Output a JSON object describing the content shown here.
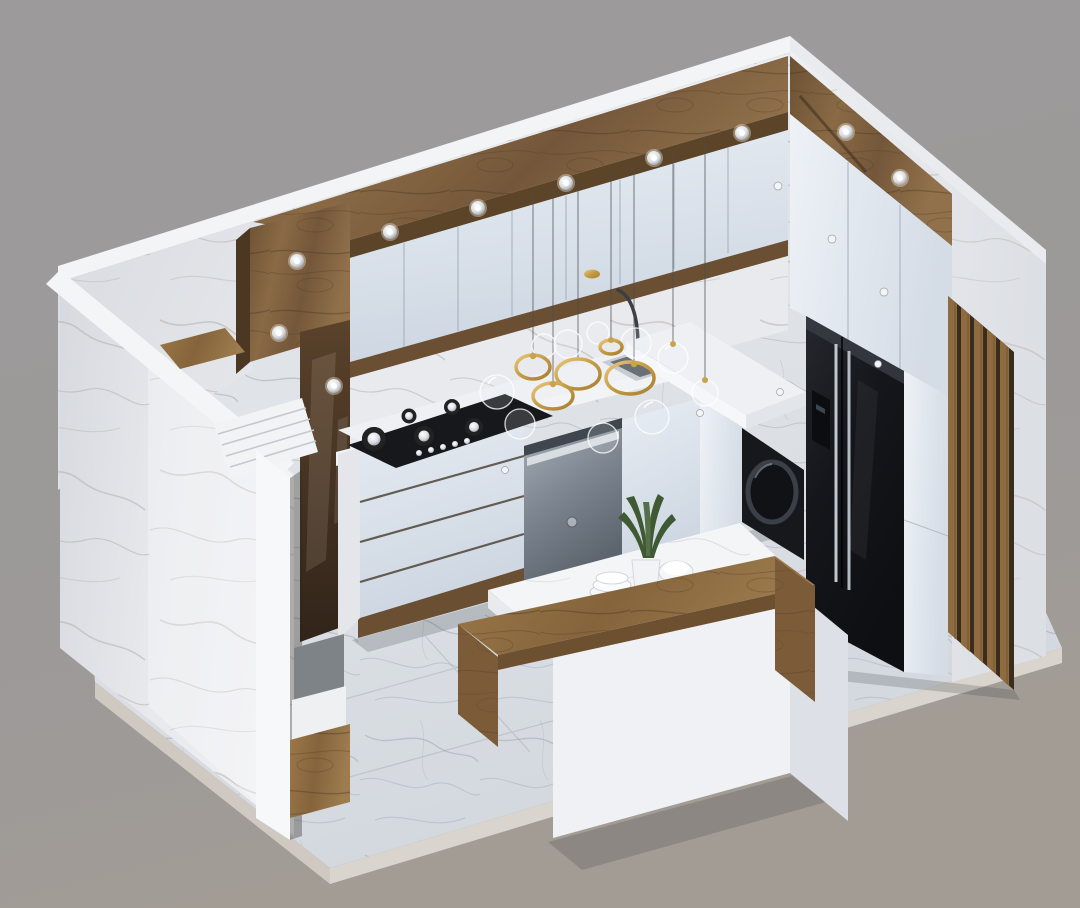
{
  "canvas": {
    "width": "1080",
    "height": "908"
  },
  "scene": {
    "title": "3D isometric cutaway render of a modern kitchen",
    "style": "white marble and walnut wood kitchen, dollhouse section view",
    "background_color": "#9b9899"
  },
  "palette": {
    "background": "#9b9899",
    "marble_light": "#eceef1",
    "marble_mid": "#dfe2e7",
    "marble_shadow": "#c9cdd4",
    "marble_rim": "#f3f4f6",
    "floor_light": "#dde1e6",
    "floor_vein": "#9aa2ae",
    "wood_dark": "#4f3a26",
    "wood_mid": "#7a5c3e",
    "wood_light": "#9a7a52",
    "wood_slat": "#8f6b40",
    "bench_wood": "#8a6a44",
    "cabinet_face": "#dde4ec",
    "cabinet_edge": "#b9c3cf",
    "appliance_black": "#17181c",
    "steel": "#79828b",
    "chrome": "#c6cbd1",
    "gold": "#c9a24b",
    "plant_green": "#3f5a33",
    "counter_white": "#f2f3f5",
    "shadow": "rgba(60,62,70,0.22)"
  },
  "objects": {
    "architecture": {
      "platform": "white marble floor slab on gray backdrop",
      "left_wall": "marble section wall with cut edge",
      "back_wall": "upper cabinets over marble backsplash",
      "right_wall": "tall units with vertical wood slat accent",
      "soffit": "walnut ceiling band with recessed spotlights"
    },
    "appliances": [
      {
        "name": "gas-cooktop",
        "burners": 5,
        "finish": "black glass"
      },
      {
        "name": "dishwasher",
        "finish": "stainless steel"
      },
      {
        "name": "washing-machine",
        "finish": "black, round door"
      },
      {
        "name": "refrigerator",
        "type": "side-by-side",
        "finish": "black, chrome handles"
      }
    ],
    "furniture": [
      {
        "name": "kitchen-island",
        "top": "white marble slab",
        "base": "white"
      },
      {
        "name": "wood-bench",
        "shape": "L-wrap around island"
      }
    ],
    "lighting": {
      "ceiling_spotlights": 10,
      "pendant": {
        "name": "glass-bubble-chandelier",
        "gold_rings": 5,
        "glass_globes": 10,
        "wires": 7
      }
    },
    "decor": [
      {
        "name": "snake-plant-in-vase"
      },
      {
        "name": "plates-stack"
      },
      {
        "name": "white-bowl"
      },
      {
        "name": "herb-plant-by-sink"
      }
    ],
    "hardware": {
      "cabinet_knobs": 7,
      "burner_knobs": 5
    }
  }
}
